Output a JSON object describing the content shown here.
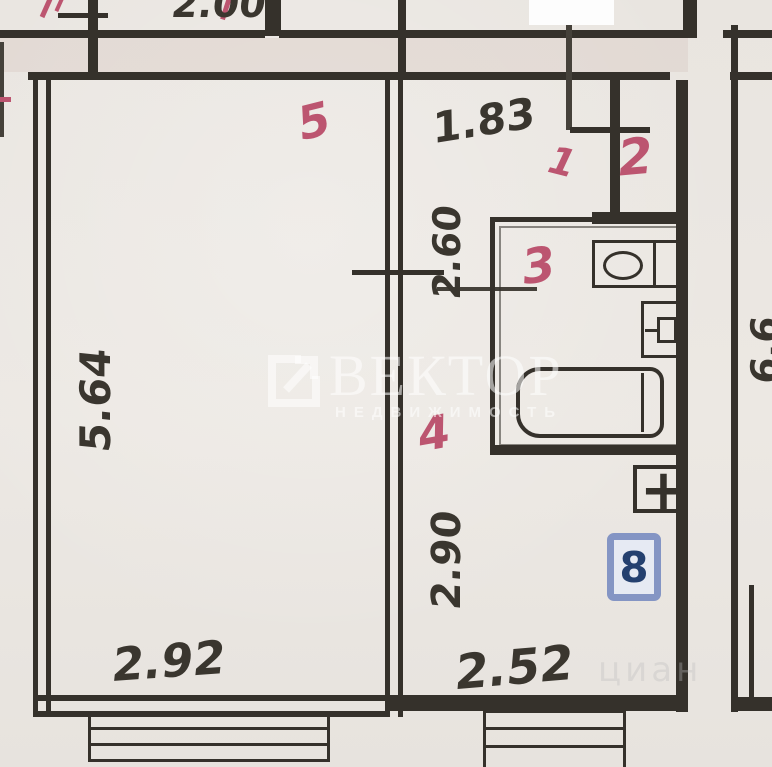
{
  "meta": {
    "kind": "scanned apartment floor plan (BTI drawing)"
  },
  "colors": {
    "paper": "#eae6e1",
    "wall_ink": "#35312b",
    "room_label_red": "#bc5570",
    "badge_frame_blue": "#8495c4",
    "badge_bg": "#e6eaf3",
    "badge_text_blue": "#24406f",
    "watermark_white": "rgba(255,255,255,0.55)"
  },
  "room_labels": {
    "room1": "1",
    "room2": "2",
    "room3": "3",
    "room4": "4",
    "room5": "5"
  },
  "dimensions": {
    "top_partial": "2.00",
    "hall_width": "1.83",
    "room5_height": "5.64",
    "room5_width": "2.92",
    "hall_height": "2.60",
    "kitchen_height": "2.90",
    "kitchen_width": "2.52",
    "right_room_partial": "6.6"
  },
  "marks": {
    "unit_badge": "8",
    "plus_mark": "+"
  },
  "watermark": {
    "brand": "ВЕКТОР",
    "subtitle": "НЕДВИЖИМОСТЬ",
    "logo_icon": "square-arrow-up-right",
    "faint_corner_text": "циан"
  }
}
